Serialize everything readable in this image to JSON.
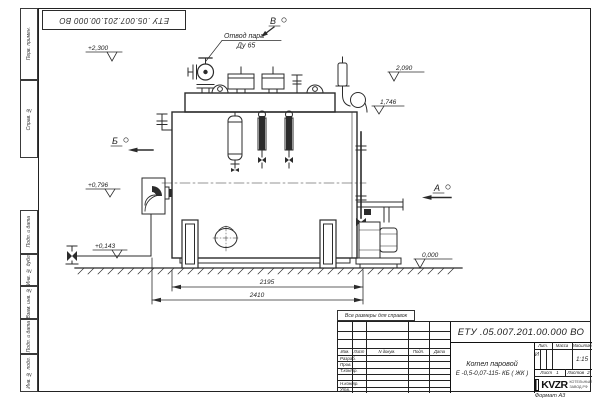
{
  "colors": {
    "ink": "#2b2b2b",
    "paper": "#ffffff"
  },
  "stamp_top": {
    "text": "ЕТУ .05.007.201.00.000  ВО"
  },
  "frame_margin_labels": [
    "Перв. примен.",
    "Справ. №",
    "Подп. и дата",
    "Инв. № дубл.",
    "Взам. инв. №",
    "Подп. и дата",
    "Инв. № подл."
  ],
  "drawing": {
    "callout": {
      "line1": "Отвод пара",
      "line2": "Ду 65"
    },
    "levels": {
      "l2300": "+2,300",
      "l2090": "2,090",
      "l1746": "1,746",
      "l0796": "+0,796",
      "l0143": "+0,143",
      "l0000": "0,000"
    },
    "views": {
      "a": "А",
      "b": "Б",
      "v": "В"
    },
    "dims": {
      "body": "2195",
      "overall": "2410"
    }
  },
  "note": "Все размеры для справок",
  "titleblock": {
    "doc_number": "ЕТУ .05.007.201.00.000  ВО",
    "product_line1": "Котел паровой",
    "product_line2": "Е -0,5-0,07-115- КБ ( ЖК )",
    "cols": {
      "izm": "Изм.",
      "list": "Лист",
      "ndoc": "N докум.",
      "podp": "Подп.",
      "data": "Дата"
    },
    "roles": {
      "razrab": "Разраб.",
      "prov": "Пров.",
      "tkontr": "Т.контр.",
      "nkontr": "Н.контр.",
      "utv": "Утв."
    },
    "props": {
      "lit": "Лит.",
      "massa": "Масса",
      "scale": "Масштаб",
      "lit_value": "И",
      "scale_value": "1:15"
    },
    "sheet": {
      "label": "Лист",
      "value": "1",
      "of_label": "Листов",
      "of_value": "2"
    },
    "logo": {
      "word": "KVZR",
      "sub1": "КОТЕЛЬНЫЙ",
      "sub2": "ЗАВОД.РФ"
    }
  },
  "format_label": "Формат А3"
}
